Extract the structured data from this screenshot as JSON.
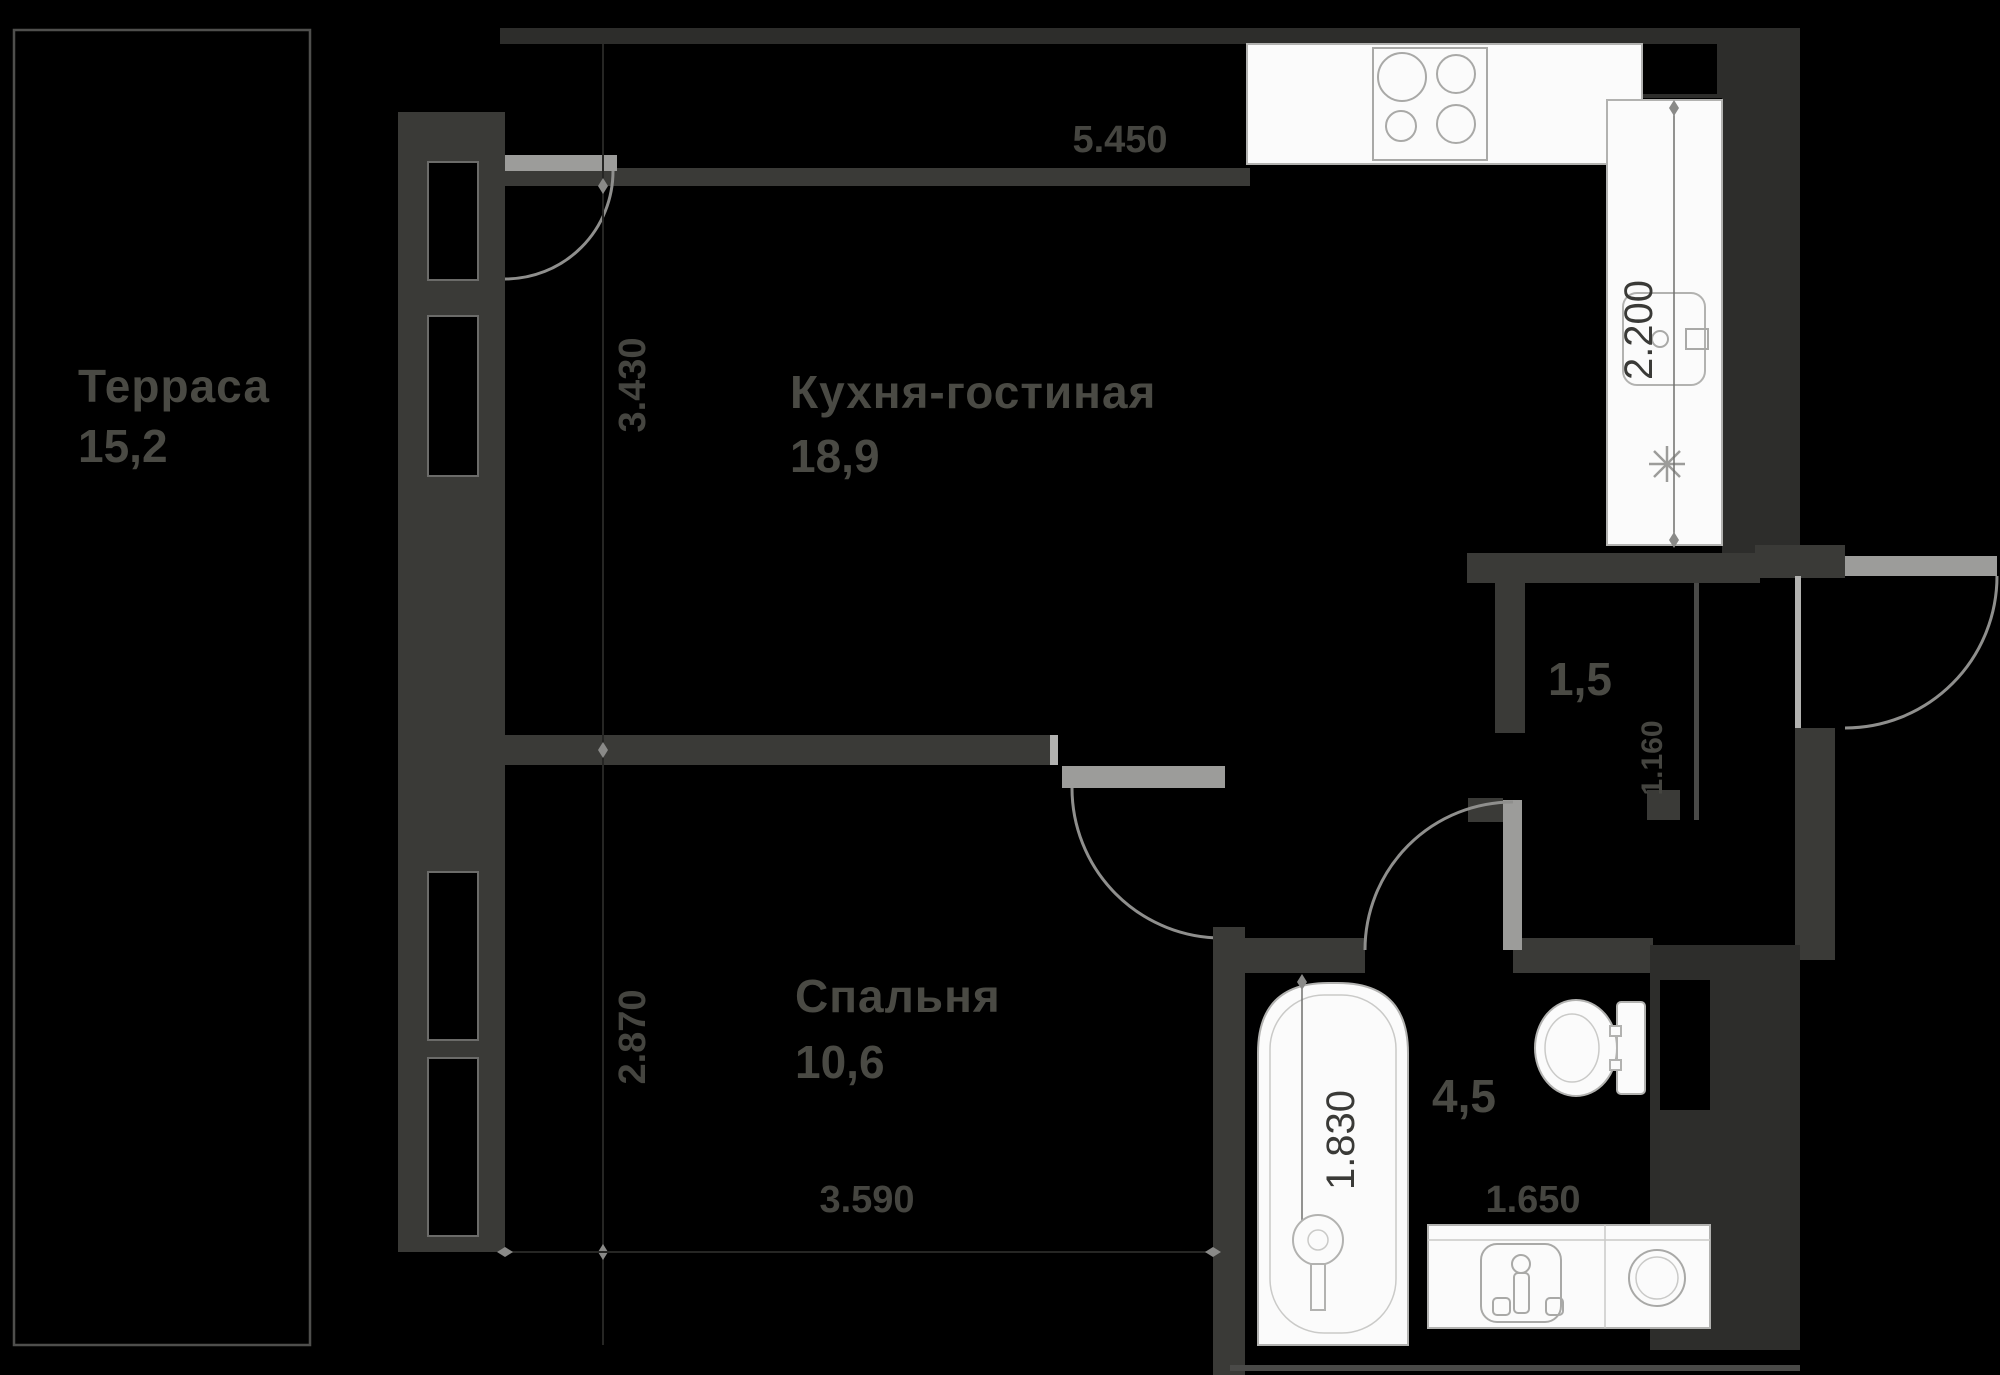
{
  "plan_type": "apartment-floor-plan",
  "colors": {
    "background": "#000000",
    "wall": "#3a3a37",
    "wall_dark": "#2d2d2b",
    "fixture_white": "#fbfbfb",
    "door_swing": "#8f8f8d",
    "label_text": "#4a4a44",
    "dim_text_on_white": "#3a3a37"
  },
  "rooms": {
    "terrace": {
      "name": "Терраса",
      "area": "15,2"
    },
    "kitchen_living": {
      "name": "Кухня-гостиная",
      "area": "18,9"
    },
    "bedroom": {
      "name": "Спальня",
      "area": "10,6"
    },
    "bathroom": {
      "area": "4,5"
    },
    "wardrobe": {
      "area": "1,5"
    }
  },
  "dimensions": {
    "kitchen_top_width": "5.450",
    "kitchen_counter_right": "2.200",
    "kitchen_left_depth": "3.430",
    "bedroom_left_depth": "2.870",
    "bedroom_bottom_width": "3.590",
    "bathtub_length": "1.830",
    "vanity_width": "1.650",
    "wardrobe_depth": "1.160"
  },
  "fixtures": {
    "stove": "stove-icon",
    "kitchen_sink": "kitchen-sink-icon",
    "bathroom_sink": "bathroom-sink-icon",
    "washing_machine": "washing-machine-icon",
    "toilet": "toilet-icon",
    "bathtub": "bathtub-icon",
    "light_point": "light-symbol-icon"
  }
}
